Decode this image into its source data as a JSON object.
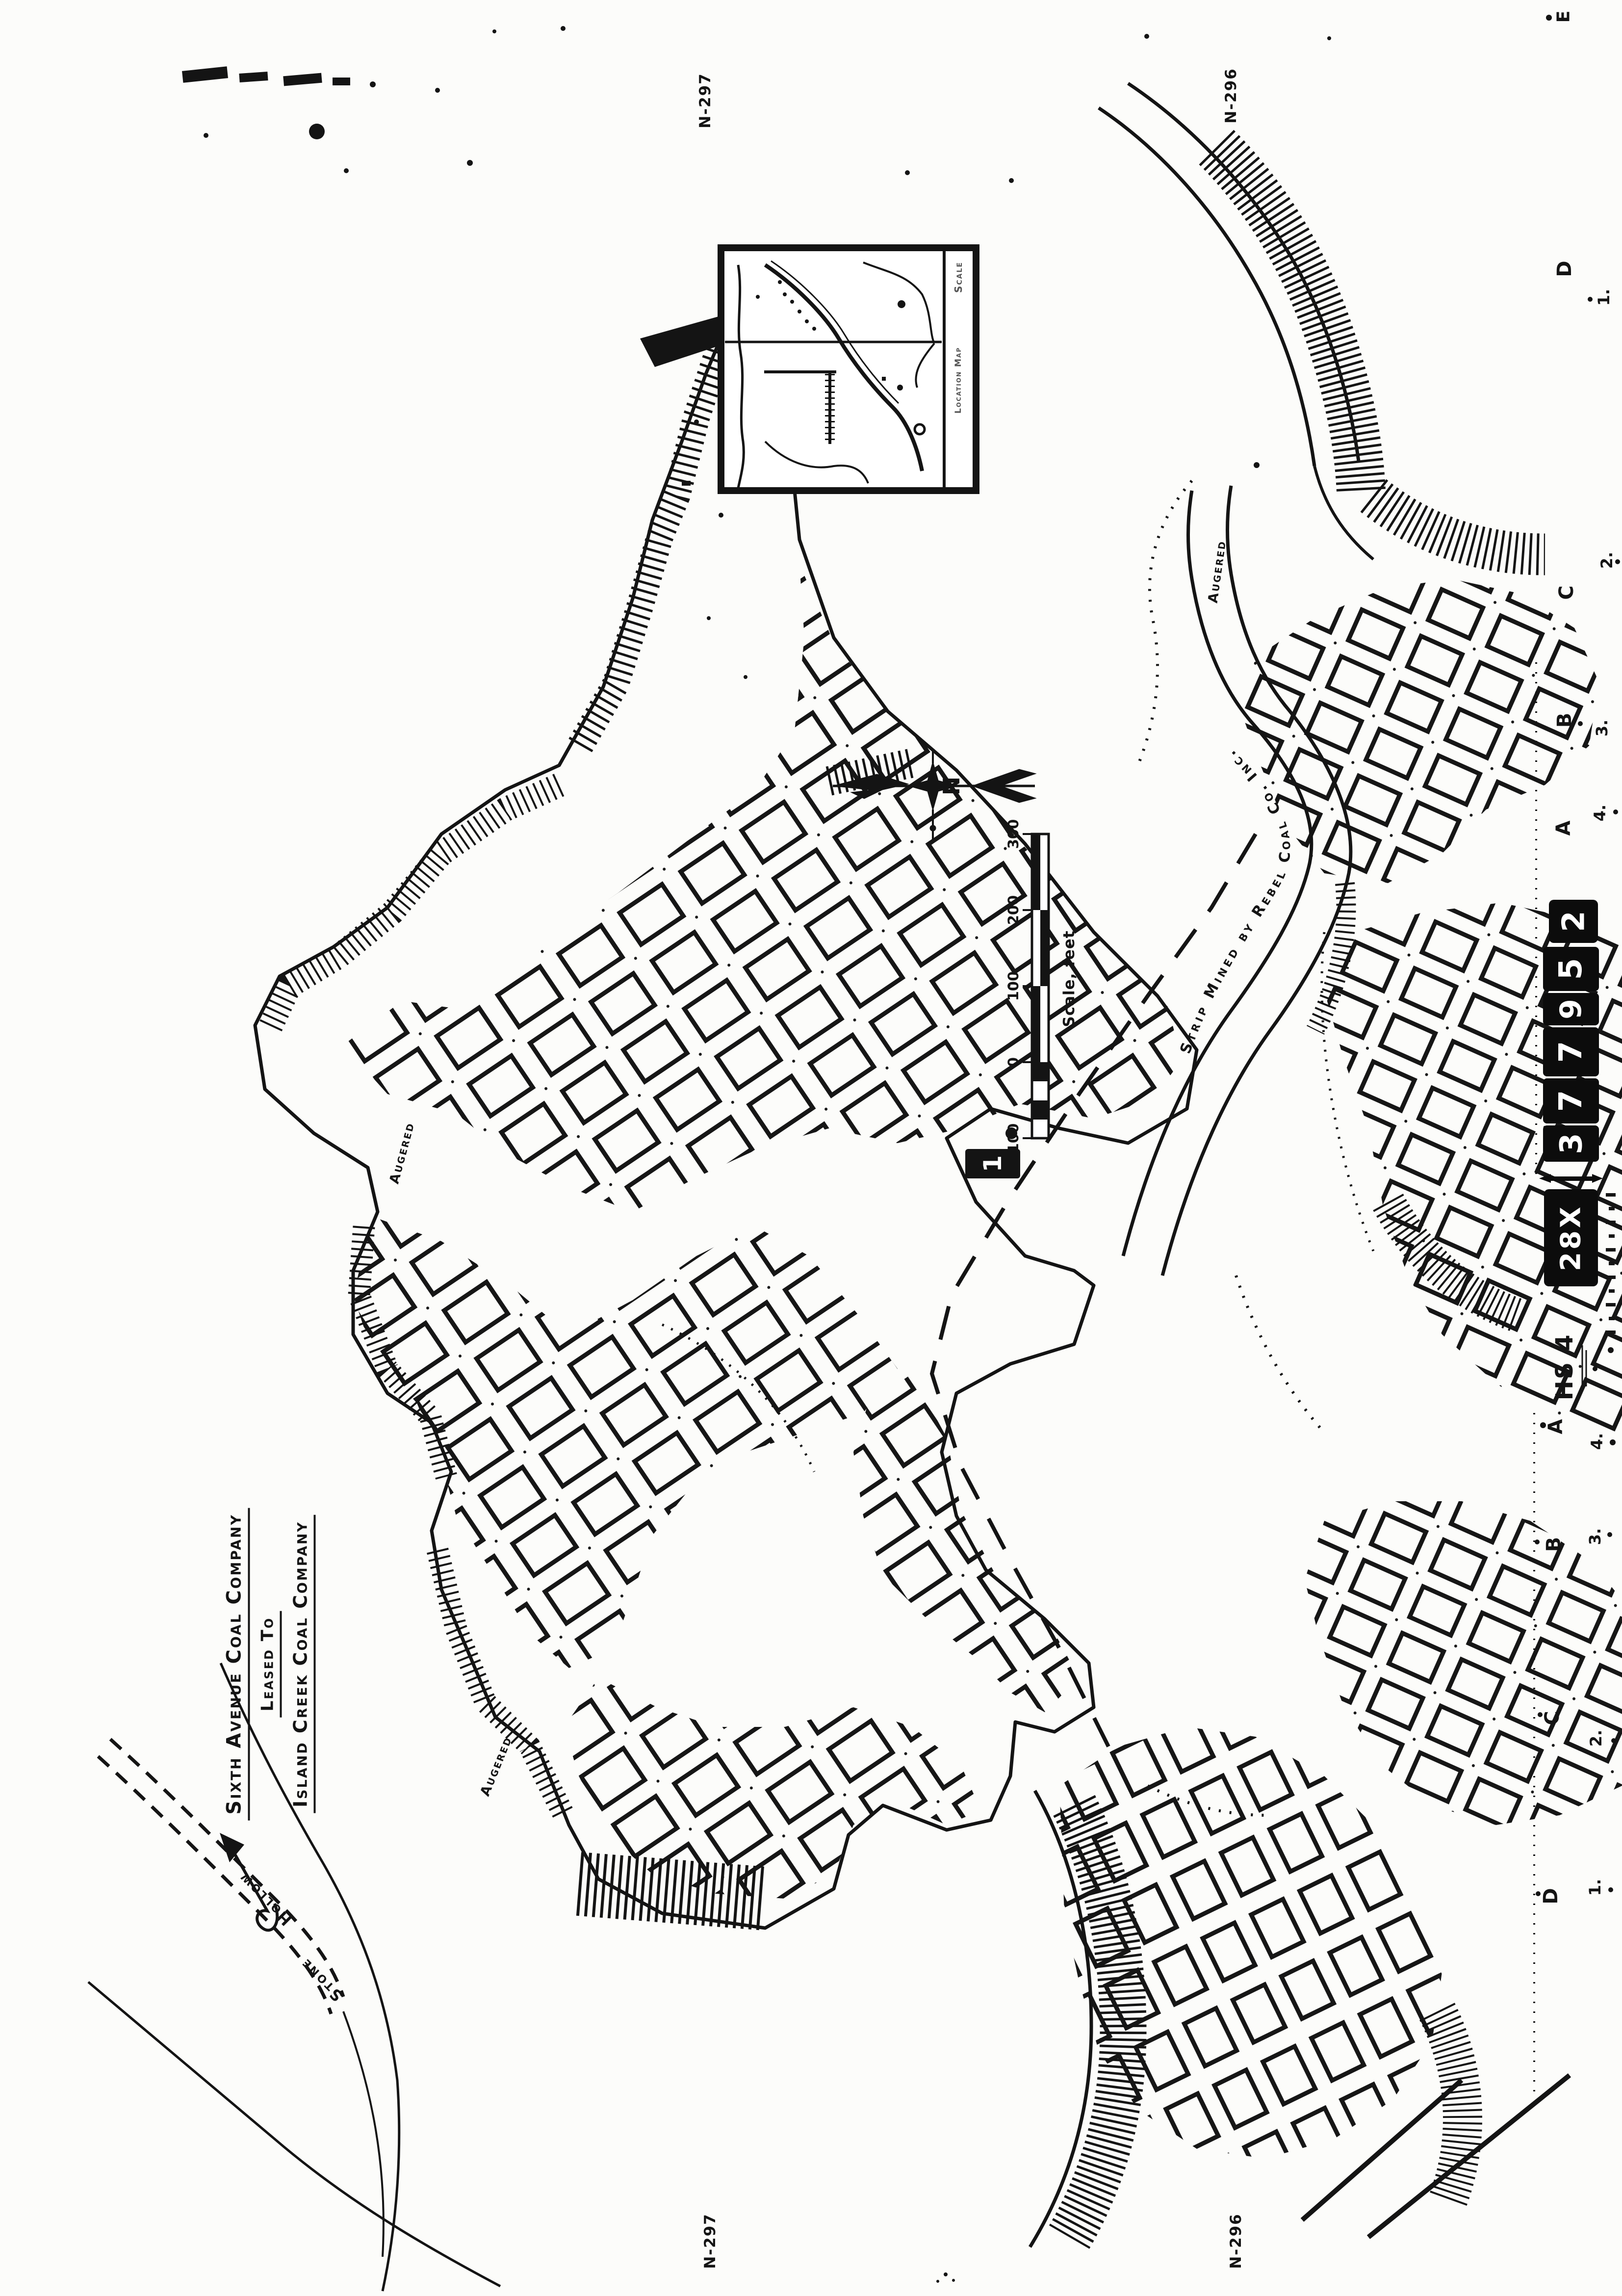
{
  "page": {
    "background": "#fcfcfa",
    "ink": "#141414"
  },
  "title_block": {
    "line1": "Sixth Avenue Coal Company",
    "line2": "Leased To",
    "line3": "Island Creek Coal Company"
  },
  "inset_map": {
    "strip_top_label": "Scale",
    "strip_bottom_label": "Location Map"
  },
  "north_arrow": {
    "label": "N"
  },
  "scale_bar": {
    "tick_labels_top_to_bottom": [
      "300",
      "200",
      "100",
      "0",
      "100"
    ],
    "caption": "Scale, feet"
  },
  "sheet_marks": {
    "big_index": "1.",
    "big_index_digit": "1",
    "id_prefix": "28X",
    "id_digits": [
      "3",
      "7",
      "7",
      "9",
      "5"
    ],
    "id_suffix": "2",
    "hs_code": "HS 4",
    "corner_top_left": "N-297",
    "corner_top_right": "N-296",
    "corner_bottom_left": "N-297",
    "corner_bottom_right": "N-296",
    "edge_top_corner": "E"
  },
  "grid_edge": {
    "top": [
      {
        "letter": "D",
        "number": "1."
      },
      {
        "letter": "C",
        "number": "2."
      },
      {
        "letter": "B",
        "number": "3."
      },
      {
        "letter": "A",
        "number": "4."
      }
    ],
    "bottom": [
      {
        "letter": "A",
        "number": "4."
      },
      {
        "letter": "B",
        "number": "3."
      },
      {
        "letter": "C",
        "number": "2."
      },
      {
        "letter": "D",
        "number": "1."
      }
    ]
  },
  "map_labels": {
    "strip_mined_band": "Strip Mined by Rebel Coal Co. Inc.",
    "augered_west": "Augered",
    "augered_south": "Augered",
    "augered_east": "Augered",
    "hollow": "Hollow",
    "stone": "Stone"
  }
}
